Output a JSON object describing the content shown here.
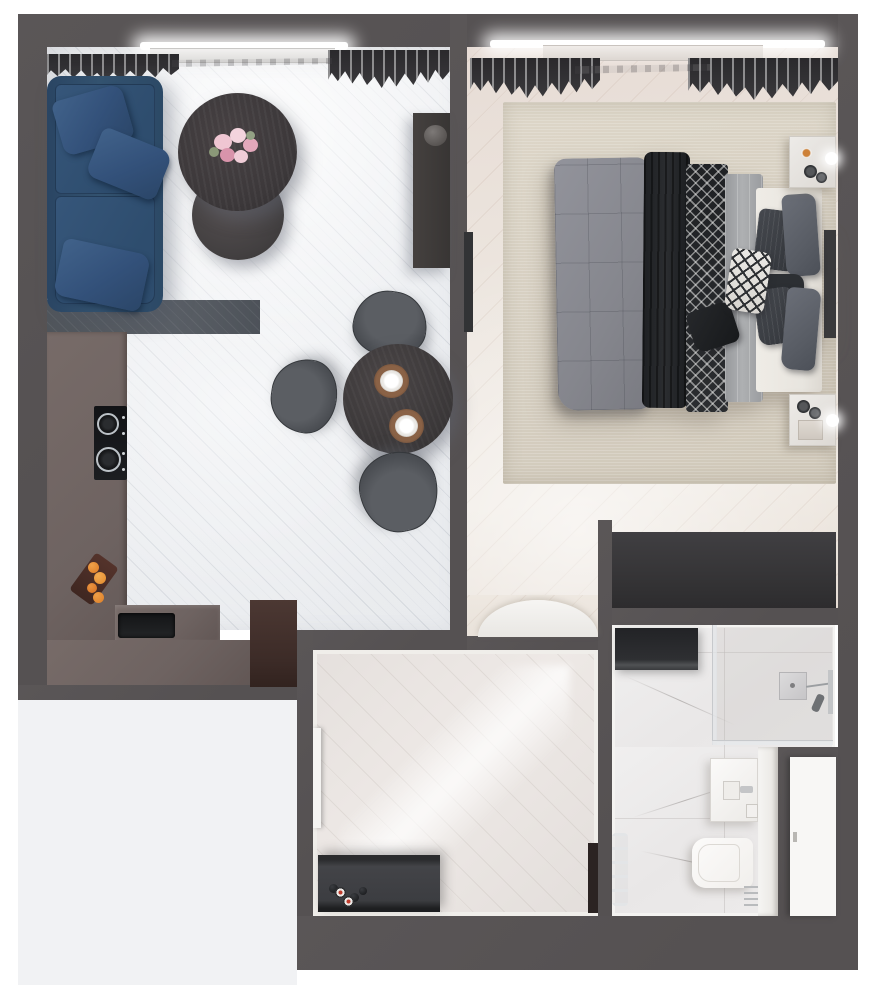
{
  "meta": {
    "kind": "3d-apartment-floor-plan-render",
    "canvas": {
      "width": 876,
      "height": 990
    },
    "visible_text": ""
  },
  "theme": {
    "colors": {
      "page_bg": "#ffffff",
      "wall": "#5a5657",
      "outside": "#f1f2f4",
      "living_floor": "#eceef1",
      "kitchen_floor": "#5a5f66",
      "counter": "#6e6361",
      "sofa": "#33526f",
      "table_dark": "#3c383a",
      "bedroom_floor": "#ece5de",
      "rug": "#d6cfc1",
      "comforter": "#85868d",
      "charcoal": "#2b2d30",
      "sheet": "#aeb0b2",
      "platform": "#e8e5df",
      "hall_floor": "#eee9e6",
      "marble": "#e9e7e7",
      "white_fixture": "#f1efec",
      "dark_unit": "#363537",
      "accent_orange": "#e2862e",
      "flower_pink": "#eec3cf",
      "door_dark": "#2b2322",
      "wood_brown": "#47332e"
    }
  },
  "rooms": {
    "living_room_kitchen": {
      "objects": [
        "window-light",
        "radiator",
        "curtains",
        "navy-sofa",
        "sofa-pillows",
        "nesting-coffee-tables",
        "pink-rose-bouquet",
        "tv-console",
        "vase",
        "round-dining-table",
        "two-place-settings",
        "three-dark-chairs",
        "l-shaped-counter",
        "induction-cooktop",
        "black-sink",
        "fruit-tray",
        "tall-brown-unit"
      ]
    },
    "bedroom": {
      "objects": [
        "window-light",
        "radiator",
        "curtains",
        "beige-rug",
        "double-bed",
        "quilted-comforter",
        "charcoal-throw",
        "patterned-runner",
        "light-sheet",
        "white-platform",
        "seven-pillows",
        "diamond-accent-pillow",
        "nightstand-top",
        "nightstand-bottom",
        "sphere-lamps",
        "wall-tv",
        "entry-mat",
        "dark-wardrobe"
      ]
    },
    "hallway": {
      "objects": [
        "glossy-floor",
        "baseboards",
        "shoe-cabinet",
        "decor-spheres",
        "candles",
        "open-door-leaf",
        "entrance-door"
      ]
    },
    "bathroom": {
      "objects": [
        "marble-floor",
        "washing-machine",
        "shower-enclosure",
        "shower-head",
        "shower-fixtures",
        "vanity-sink",
        "faucet",
        "partition",
        "toilet",
        "towel-warmer",
        "white-door-leaf"
      ]
    }
  }
}
